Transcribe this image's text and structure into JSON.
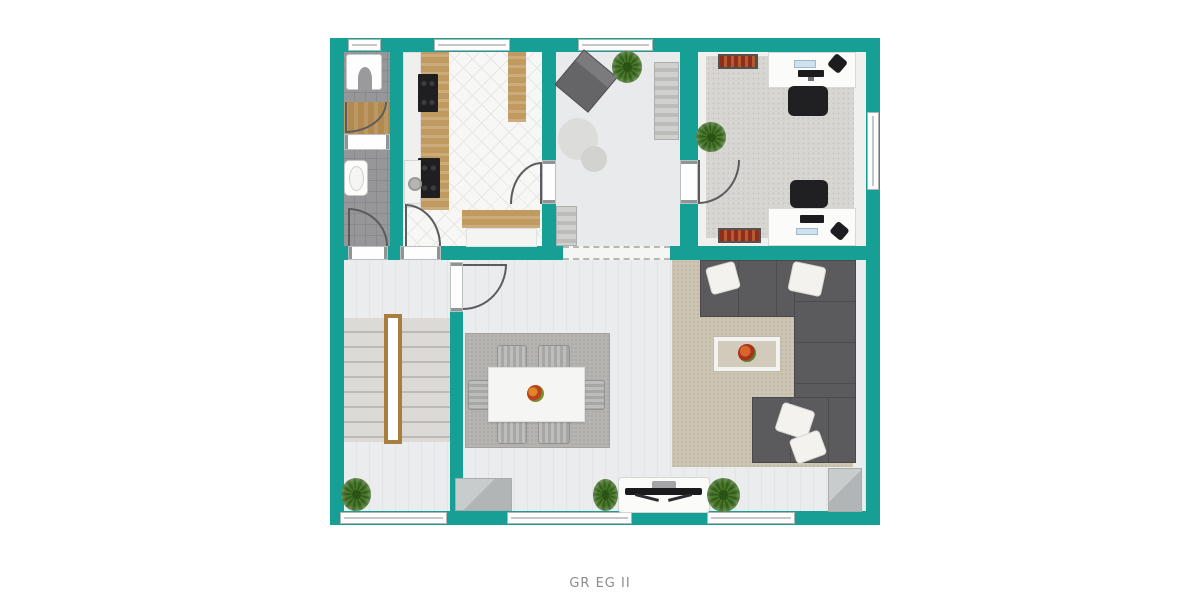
{
  "caption": "GR EG II",
  "palette": {
    "wall": "#16a095",
    "floor_light": "#ebeced",
    "tile_gray": "#97979a",
    "tile_white": "#f7f7f6",
    "carpet_office": "#d7d6d3",
    "carpet_living": "#ccc5b4",
    "rug_dining": "#b6b4b0",
    "sofa": "#5b5b5d",
    "wood": "#c19a60",
    "radiator": "#8e2e1e",
    "plant": "#47782a",
    "caption_text": "#8c8c8c"
  },
  "plan": {
    "name": "ground-floor-plan",
    "rooms": [
      {
        "name": "shower-room",
        "furniture": [
          "shower",
          "wood-floor-mat",
          "door"
        ]
      },
      {
        "name": "wc",
        "furniture": [
          "sink",
          "door"
        ]
      },
      {
        "name": "kitchen",
        "furniture": [
          "counter",
          "cooktop",
          "oven",
          "washing-machine",
          "tall-cabinet",
          "island-counter",
          "door",
          "door"
        ]
      },
      {
        "name": "multipurpose-room",
        "furniture": [
          "armchair",
          "potted-plant",
          "striped-runner",
          "round-rug",
          "striped-mat"
        ]
      },
      {
        "name": "office",
        "furniture": [
          "radiator",
          "radiator",
          "desk",
          "desk",
          "office-chair",
          "office-chair",
          "monitor",
          "monitor",
          "phone",
          "phone",
          "potted-plant",
          "carpet",
          "door"
        ]
      },
      {
        "name": "hallway",
        "furniture": [
          "staircase",
          "handrail",
          "potted-plant"
        ]
      },
      {
        "name": "dining-area",
        "furniture": [
          "rug",
          "dining-table",
          "chair",
          "chair",
          "chair",
          "chair",
          "chair",
          "chair",
          "fruit-bowl",
          "doormat",
          "tv-lowboard",
          "tv",
          "potted-plant",
          "door"
        ]
      },
      {
        "name": "living-room",
        "furniture": [
          "corner-sofa",
          "pillow",
          "pillow",
          "pillow",
          "pillow",
          "coffee-table",
          "flower-vase",
          "carpet",
          "potted-plant",
          "doormat"
        ]
      }
    ],
    "windows": {
      "top_wall": 3,
      "bottom_wall": 3,
      "right_wall": 1
    },
    "open_passage": "dashed line between multipurpose room and dining area"
  }
}
